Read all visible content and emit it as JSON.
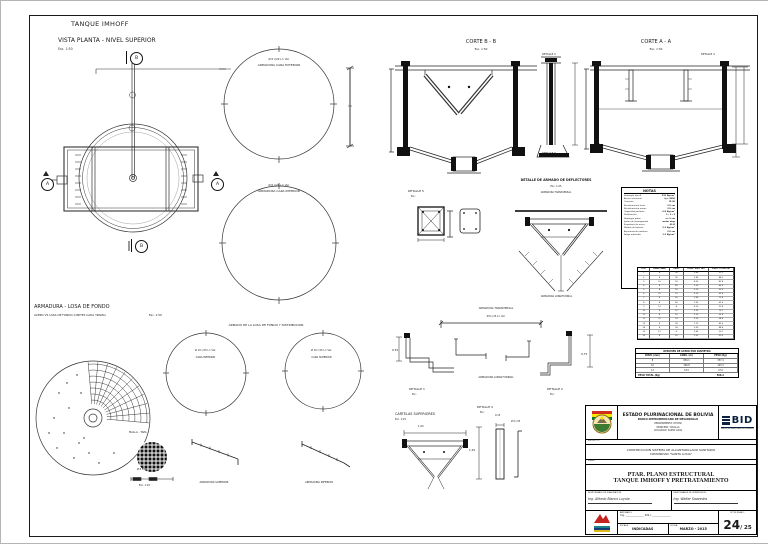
{
  "sheet": {
    "title": "TANQUE IMHOFF",
    "view_title": "VISTA PLANTA - NIVEL SUPERIOR",
    "view_scale": "Esc. 1:50"
  },
  "plan": {
    "marker_a": "A",
    "marker_b": "B"
  },
  "top_circles": {
    "outer_note": "Ø 8 c/20  L= Var.",
    "outer_label": "ARMADURA CARA EXTERIOR",
    "inner_note": "Ø 8 c/20  L= Var.",
    "inner_label": "ARMADURA CARA INTERIOR"
  },
  "cortes": {
    "b_title": "CORTE B - B",
    "b_scale": "Esc. 1:50",
    "a_title": "CORTE A - A",
    "a_scale": "Esc. 1:50"
  },
  "detalles": {
    "d1": "DETALLE 1",
    "d2": "DETALLE 2",
    "d3": "DETALLE 3",
    "d4": "DETALLE 4",
    "d5": "DETALLE 5",
    "esc": "Esc:"
  },
  "deflectores": {
    "title": "DETALLE DE ARMADO DE DEFLECTORES",
    "scale": "Esc. 1:25",
    "top_label": "ARMADURA TRANSVERSAL",
    "bottom_label": "ARMADURA LONGITUDINAL"
  },
  "notes": {
    "title": "NOTAS",
    "items": [
      {
        "l": "Hormigón tipo A",
        "r": "210 Kg/cm²"
      },
      {
        "l": "Acero estructural",
        "r": "fy= 4200"
      },
      {
        "l": "Cemento",
        "r": "IP-30"
      },
      {
        "l": "Recubrimiento losas",
        "r": "2.0 cm"
      },
      {
        "l": "Recubrimiento muros",
        "r": "2.5 cm"
      },
      {
        "l": "Capacidad portante",
        "r": "0.8 Kg/cm²"
      },
      {
        "l": "Dosificación",
        "r": "1 : 2 : 3"
      },
      {
        "l": "Hormigón pobre",
        "r": "e= 5 cm"
      },
      {
        "l": "Juntas de hormigonado",
        "r": "water stop"
      },
      {
        "l": "Empalmes de acero",
        "r": "40 Ø"
      },
      {
        "l": "Módulo de balasto",
        "r": "2.2 Kg/cm³"
      },
      {
        "l": "Asentamiento máximo",
        "r": "2.5 cm"
      },
      {
        "l": "Fatiga admisible",
        "r": "1.2 Kg/cm²"
      }
    ]
  },
  "rebar_table": {
    "headers": [
      "POS.",
      "DIAM. (mm)",
      "CANT.",
      "LONG. UNIT. (m)",
      "LONG. TOTAL (m)"
    ],
    "rows": [
      [
        "1",
        "8",
        "24",
        "3.80",
        "91.2"
      ],
      [
        "2",
        "8",
        "36",
        "2.45",
        "88.2"
      ],
      [
        "3",
        "10",
        "18",
        "4.60",
        "82.8"
      ],
      [
        "4",
        "8",
        "45",
        "1.90",
        "85.5"
      ],
      [
        "5",
        "8",
        "30",
        "3.10",
        "93.0"
      ],
      [
        "6",
        "10",
        "12",
        "5.20",
        "62.4"
      ],
      [
        "7",
        "8",
        "26",
        "2.80",
        "72.8"
      ],
      [
        "8",
        "8",
        "40",
        "1.55",
        "62.0"
      ],
      [
        "9",
        "12",
        "8",
        "4.10",
        "32.8"
      ],
      [
        "10",
        "8",
        "22",
        "3.35",
        "73.7"
      ],
      [
        "11",
        "8",
        "16",
        "2.10",
        "33.6"
      ],
      [
        "12",
        "10",
        "14",
        "3.90",
        "54.6"
      ],
      [
        "13",
        "8",
        "28",
        "1.75",
        "49.0"
      ],
      [
        "14",
        "8",
        "34",
        "2.60",
        "88.4"
      ],
      [
        "15",
        "12",
        "6",
        "3.45",
        "20.7"
      ],
      [
        "16",
        "8",
        "20",
        "2.95",
        "59.0"
      ]
    ]
  },
  "steel_summary": {
    "title": "RESUMEN DE ACERO POR DIAMETRO",
    "headers": [
      "DIAM. (mm)",
      "LONG. (m)",
      "PESO (Kg)"
    ],
    "rows": [
      [
        "8",
        "854.1",
        "337.4"
      ],
      [
        "10",
        "199.8",
        "123.3"
      ],
      [
        "12",
        "53.5",
        "47.5"
      ]
    ],
    "total_label": "PESO TOTAL (Kg)",
    "total_value": "508.2"
  },
  "losa": {
    "title": "ARMADURA - LOSA DE FONDO",
    "subtitle": "ACERO VS LOSA DE FONDO (LIMITES CADA TRAMA)",
    "scale": "Esc. 1:50",
    "armado_title": "ARMADO DE LA LOSA DE FONDO Y DISTRIBUCION",
    "c1_note": "Ø 10 c/15  L= Var.",
    "c1_label": "CARA INFERIOR",
    "c2_note": "Ø 10 c/15  L= Var.",
    "c2_label": "CARA SUPERIOR",
    "malla_label": "MALLA - TAPA",
    "malla_note": "Ø 8  c/10",
    "malla_scale": "Esc. 1:10",
    "sup_label": "ARMADURA SUPERIOR",
    "inf_label": "ARMADURA INFERIOR"
  },
  "bottom_details": {
    "dim_left": "0.55",
    "dim_right": "0.75",
    "bar_note": "Ø 8 c/15  L= Var.",
    "cartelas_title": "CARTELAS SUPERIORES",
    "cartelas_scale": "Esc. 1:25",
    "dim_100": "1.00",
    "dim_120": "1.20",
    "dim_015": "0.15",
    "wall_note": "Ø 8 c/15"
  },
  "title_block": {
    "country": "ESTADO PLURINACIONAL DE BOLIVIA",
    "bank": "BANCO INTERAMERICANO DE DESARROLLO",
    "dept": "DEPARTAMENTO: POTOSI",
    "municipio": "MUNICIPIO: YOCALLA",
    "localidad": "LOCALIDAD: SANTA LUCIA",
    "bid": "BID",
    "bid_sub": "Banco Interamericano de Desarrollo",
    "project_label": "PROYECTO:",
    "project_line1": "CONSTRUCCION SISTEMA DE ALCANTARILLADO SANITARIO",
    "project_line2": "COMUNIDAD \"SANTA LUCIA\"",
    "plano_label": "PLANO:",
    "sheet_line1": "PTAR. PLANO ESTRUCTURAL",
    "sheet_line2": "TANQUE IMHOFF Y PRETRATAMIENTO",
    "sig1_label": "RESPONSABLE DE ELABORACION:",
    "sig1_name": "Ing. Alfredo Blanco Loyola",
    "sig2_label": "RESPONSABLE DE SUPERVISION:",
    "sig2_name": "Ing. Walter Saavedra",
    "aprob_label": "APROBADO:",
    "aprob_line1": "Ing. ______________",
    "aprob_line2": "R.N.I. ______________",
    "escala_label": "ESCALA:",
    "escala_value": "INDICADAS",
    "fecha_label": "FECHA:",
    "fecha_value": "MARZO - 2015",
    "plano_num_label": "Nº DE PLANO:",
    "sheet_num": "24",
    "sheet_total": "/ 25"
  }
}
